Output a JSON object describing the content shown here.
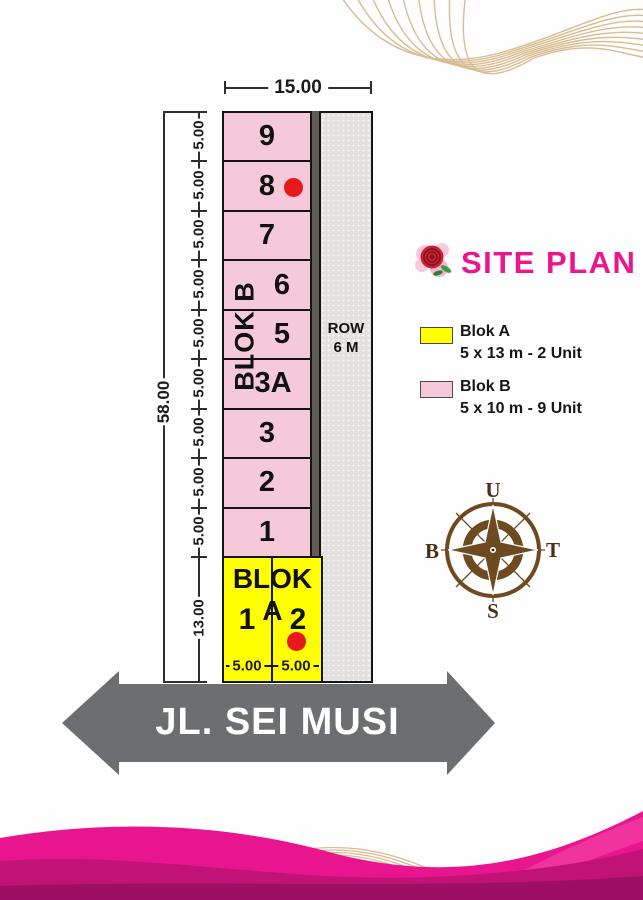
{
  "colors": {
    "accent_pink": "#EA168C",
    "blok_a_fill": "#FFFF00",
    "blok_b_fill": "#F6C9DA",
    "road_fill": "#E2E1DF",
    "road_strip": "#605C54",
    "street_arrow_gray": "#6D6E70",
    "marker_red": "#E8191C",
    "compass_brown": "#6E4A21",
    "wave_gold": "#D9BC92",
    "wave_magenta": "#E9158E"
  },
  "plan": {
    "width_total": "15.00",
    "height_total": "58.00",
    "segment_height": "5.00",
    "blok_a_height": "13.00",
    "lot_width": "5.00",
    "blok_b": {
      "label": "BLOK B",
      "lots": [
        "9",
        "8",
        "7",
        "6",
        "5",
        "3A",
        "3",
        "2",
        "1"
      ]
    },
    "blok_a": {
      "label": "BLOK A",
      "lots": [
        "1",
        "2"
      ]
    },
    "road": {
      "line1": "ROW",
      "line2": "6 M"
    }
  },
  "panel": {
    "title": "SITE PLAN",
    "legend": [
      {
        "name": "Blok A",
        "size": "5 x 13 m - 2 Unit"
      },
      {
        "name": "Blok B",
        "size": "5 x 10 m - 9 Unit"
      }
    ],
    "compass": {
      "north": "U",
      "east": "T",
      "south": "S",
      "west": "B"
    }
  },
  "street": {
    "name": "JL. SEI MUSI"
  }
}
